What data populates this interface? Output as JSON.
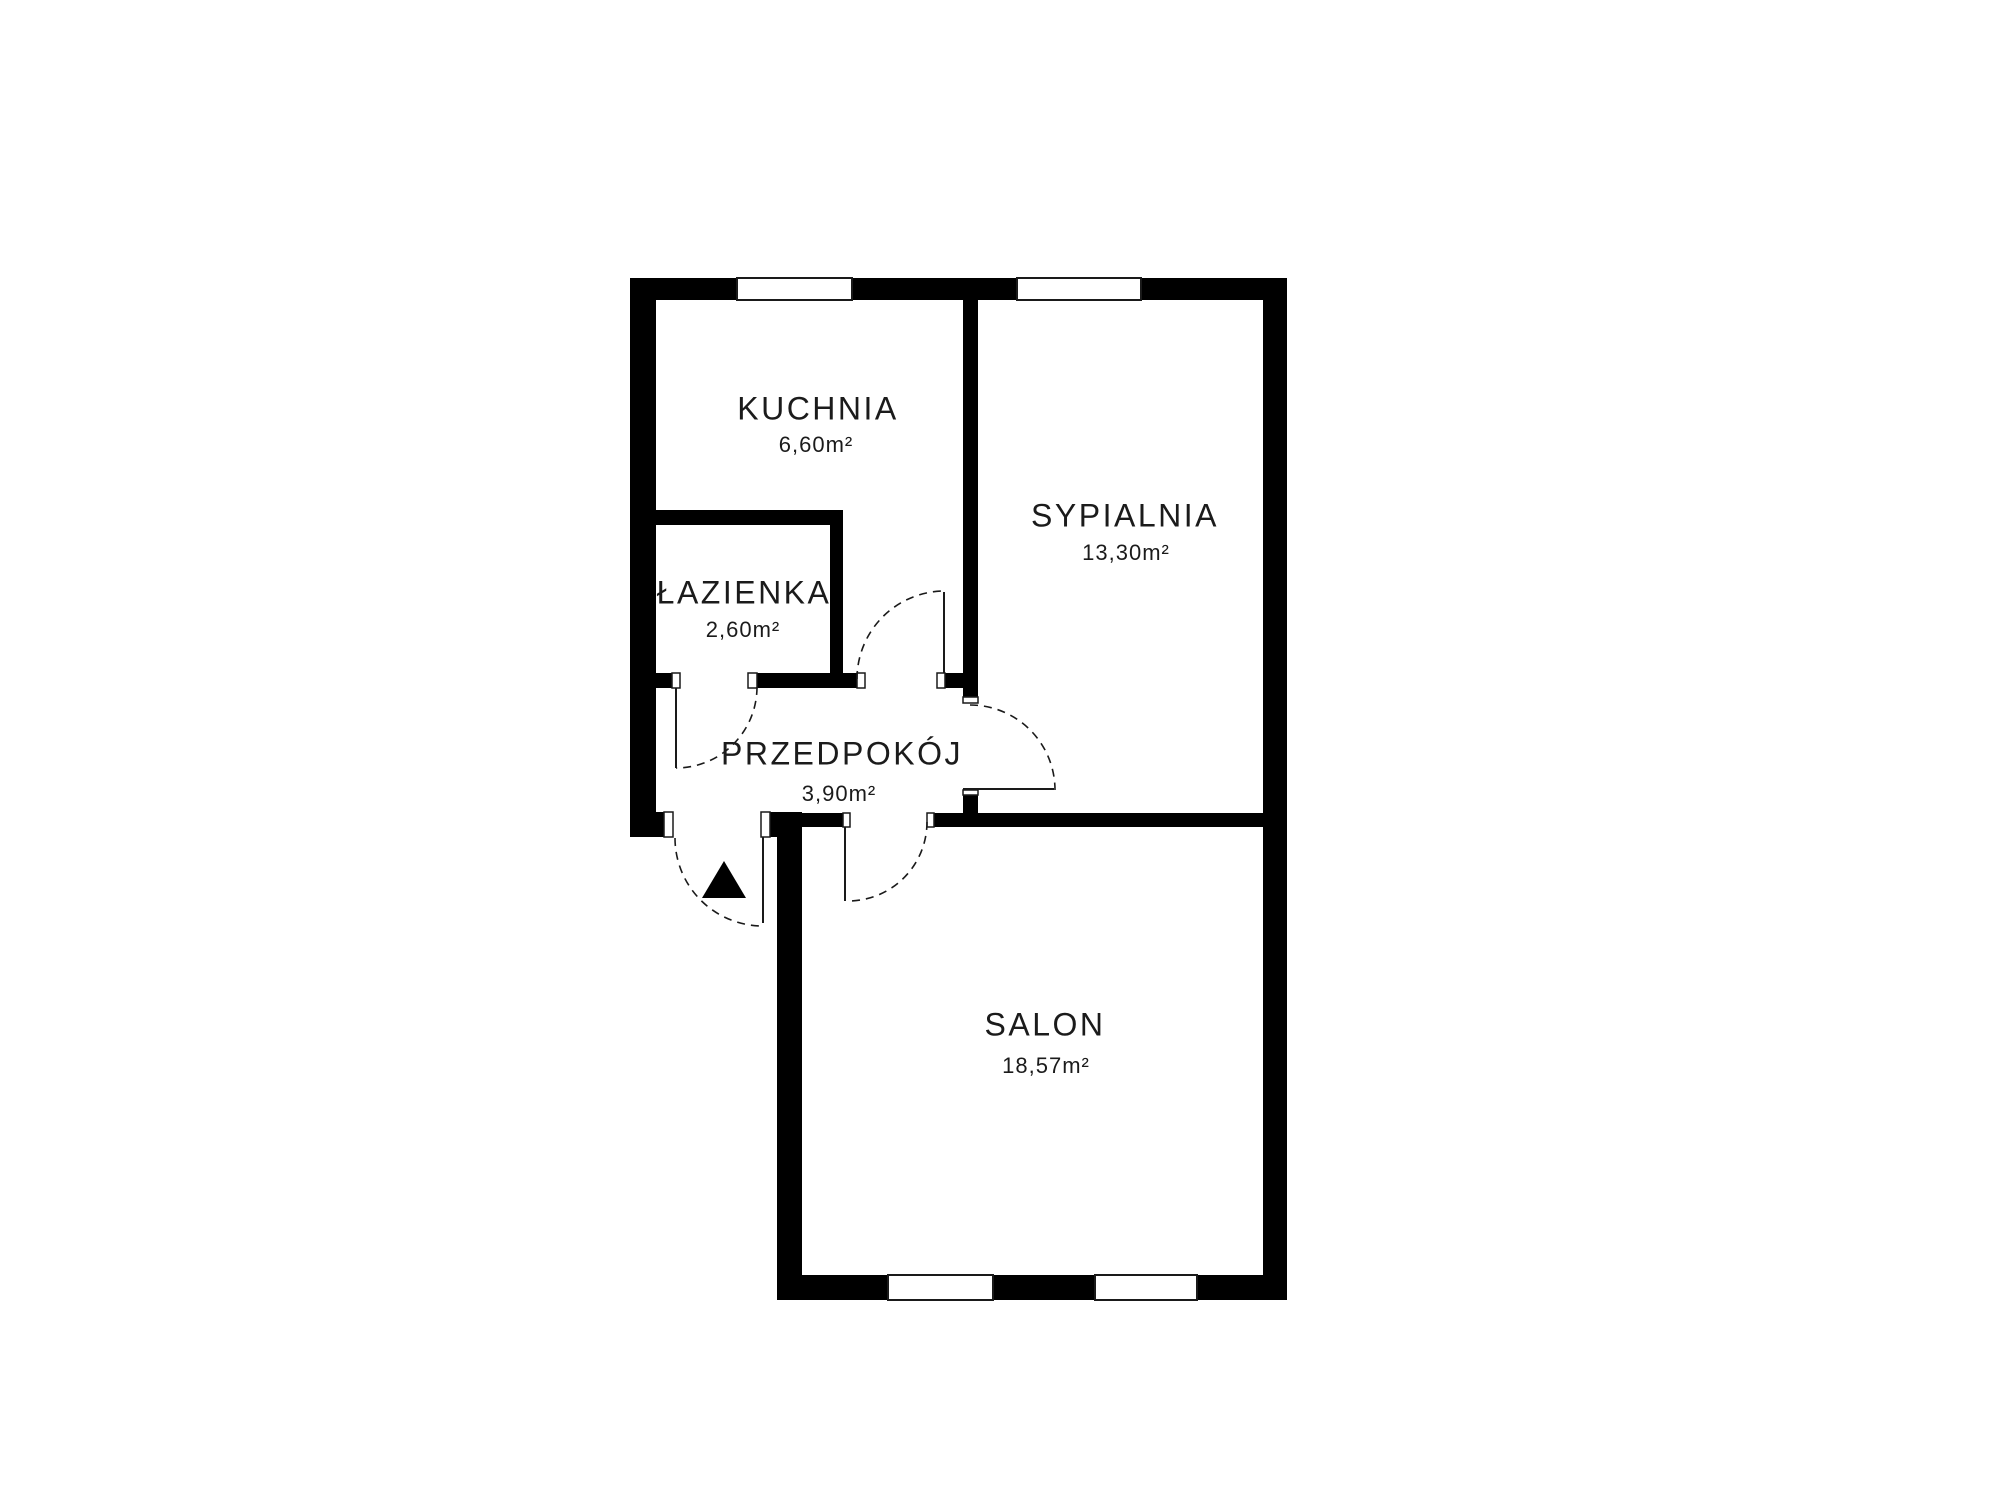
{
  "floorplan": {
    "canvas": {
      "width": 2000,
      "height": 1500,
      "background": "#ffffff"
    },
    "colors": {
      "wall": "#000000",
      "line": "#1a1a1a",
      "opening": "#ffffff"
    },
    "rooms": [
      {
        "name": "KUCHNIA",
        "area": "6,60m²",
        "cx": 818,
        "cy": 409,
        "area_cx": 816,
        "area_cy": 442
      },
      {
        "name": "SYPIALNIA",
        "area": "13,30m²",
        "cx": 1125,
        "cy": 516,
        "area_cx": 1126,
        "area_cy": 550
      },
      {
        "name": "ŁAZIENKA",
        "area": "2,60m²",
        "cx": 744,
        "cy": 593,
        "area_cx": 743,
        "area_cy": 627
      },
      {
        "name": "PRZEDPOKÓJ",
        "area": "3,90m²",
        "cx": 842,
        "cy": 754,
        "area_cx": 839,
        "area_cy": 791
      },
      {
        "name": "SALON",
        "area": "18,57m²",
        "cx": 1045,
        "cy": 1025,
        "area_cx": 1046,
        "area_cy": 1063
      }
    ],
    "walls": [
      {
        "id": "outer-top",
        "x": 630,
        "y": 278,
        "w": 657,
        "h": 22
      },
      {
        "id": "outer-left",
        "x": 630,
        "y": 278,
        "w": 26,
        "h": 559
      },
      {
        "id": "outer-right",
        "x": 1263,
        "y": 278,
        "w": 24,
        "h": 1022
      },
      {
        "id": "outer-bottom",
        "x": 777,
        "y": 1275,
        "w": 510,
        "h": 25
      },
      {
        "id": "salon-left-exterior",
        "x": 777,
        "y": 812,
        "w": 25,
        "h": 463
      },
      {
        "id": "entrance-jamb-left",
        "x": 656,
        "y": 812,
        "w": 12,
        "h": 25
      },
      {
        "id": "entrance-jamb-right",
        "x": 769,
        "y": 812,
        "w": 8,
        "h": 25
      },
      {
        "id": "bathroom-top",
        "x": 656,
        "y": 510,
        "w": 187,
        "h": 15
      },
      {
        "id": "bathroom-right",
        "x": 830,
        "y": 510,
        "w": 13,
        "h": 178
      },
      {
        "id": "bathroom-bottom-stub",
        "x": 656,
        "y": 673,
        "w": 16,
        "h": 15
      },
      {
        "id": "bathroom-bottom-seg",
        "x": 757,
        "y": 673,
        "w": 100,
        "h": 15
      },
      {
        "id": "kitchen-door-jamb",
        "x": 945,
        "y": 673,
        "w": 18,
        "h": 15
      },
      {
        "id": "hall-bedroom-divider",
        "x": 963,
        "y": 300,
        "w": 15,
        "h": 403
      },
      {
        "id": "divider-bottom-stub",
        "x": 963,
        "y": 790,
        "w": 15,
        "h": 23
      },
      {
        "id": "salon-top-left-seg",
        "x": 777,
        "y": 813,
        "w": 66,
        "h": 14
      },
      {
        "id": "salon-top-right-seg",
        "x": 934,
        "y": 813,
        "w": 329,
        "h": 14
      }
    ],
    "windows": [
      {
        "id": "window-kitchen-top",
        "x": 737,
        "y": 278,
        "w": 115,
        "h": 22
      },
      {
        "id": "window-bedroom-top",
        "x": 1017,
        "y": 278,
        "w": 124,
        "h": 22
      },
      {
        "id": "window-salon-left",
        "x": 888,
        "y": 1275,
        "w": 105,
        "h": 25
      },
      {
        "id": "window-salon-right",
        "x": 1095,
        "y": 1275,
        "w": 102,
        "h": 25
      }
    ],
    "door_frames": [
      {
        "id": "entrance-frame-left",
        "x": 664,
        "y": 812,
        "w": 9,
        "h": 25
      },
      {
        "id": "entrance-frame-right",
        "x": 761,
        "y": 812,
        "w": 9,
        "h": 25
      },
      {
        "id": "bathroom-frame-left",
        "x": 672,
        "y": 673,
        "w": 8,
        "h": 15
      },
      {
        "id": "bathroom-frame-right",
        "x": 748,
        "y": 673,
        "w": 9,
        "h": 15
      },
      {
        "id": "kitchen-frame-left",
        "x": 857,
        "y": 673,
        "w": 8,
        "h": 15
      },
      {
        "id": "kitchen-frame-right",
        "x": 937,
        "y": 673,
        "w": 8,
        "h": 15
      },
      {
        "id": "bedroom-frame-top",
        "x": 963,
        "y": 697,
        "w": 15,
        "h": 6
      },
      {
        "id": "bedroom-frame-bottom",
        "x": 963,
        "y": 790,
        "w": 15,
        "h": 5
      },
      {
        "id": "salon-frame-left",
        "x": 843,
        "y": 813,
        "w": 7,
        "h": 14
      },
      {
        "id": "salon-frame-right",
        "x": 927,
        "y": 813,
        "w": 7,
        "h": 14
      }
    ],
    "door_leaves": [
      {
        "id": "bathroom-door-leaf",
        "x1": 676,
        "y1": 688,
        "x2": 676,
        "y2": 768
      },
      {
        "id": "kitchen-door-leaf",
        "x1": 944,
        "y1": 592,
        "x2": 944,
        "y2": 673
      },
      {
        "id": "bedroom-door-leaf",
        "x1": 963,
        "y1": 789,
        "x2": 1054,
        "y2": 789
      },
      {
        "id": "salon-door-leaf",
        "x1": 845,
        "y1": 827,
        "x2": 845,
        "y2": 901
      },
      {
        "id": "entrance-door-leaf",
        "x1": 763,
        "y1": 837,
        "x2": 763,
        "y2": 923
      }
    ],
    "door_arcs": [
      {
        "id": "bathroom-door-arc",
        "d": "M 757 687 A 81 81 0 0 1 676 768"
      },
      {
        "id": "kitchen-door-arc",
        "d": "M 857 679 A 88 88 0 0 1 945 591"
      },
      {
        "id": "bedroom-door-arc",
        "d": "M 970 705 A 85 85 0 0 1 1055 790"
      },
      {
        "id": "salon-door-arc",
        "d": "M 927 822 A 79 79 0 0 1 848 901"
      },
      {
        "id": "entrance-door-arc",
        "d": "M 675 838 A 88 88 0 0 0 763 926"
      }
    ],
    "entrance_marker": {
      "id": "entrance-arrow",
      "points": "724,861 702,898 746,898"
    }
  }
}
